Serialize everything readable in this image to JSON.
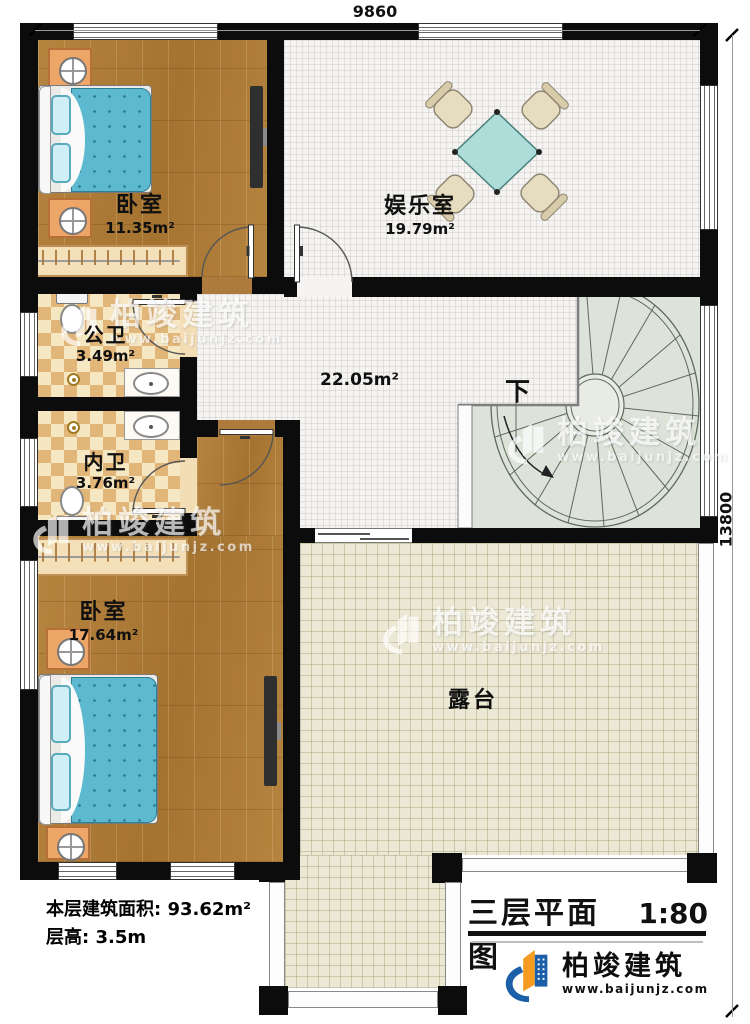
{
  "dimensions": {
    "top": "9860",
    "right": "13800"
  },
  "rooms": {
    "bedroom1": {
      "name": "卧室",
      "area": "11.35m²"
    },
    "entertainment": {
      "name": "娱乐室",
      "area": "19.79m²"
    },
    "public_bath": {
      "name": "公卫",
      "area": "3.49m²"
    },
    "private_bath": {
      "name": "内卫",
      "area": "3.76m²"
    },
    "bedroom2": {
      "name": "卧室",
      "area": "17.64m²"
    },
    "hall": {
      "area": "22.05m²"
    },
    "terrace": {
      "name": "露台"
    },
    "stairs": {
      "direction_label": "下"
    }
  },
  "info": {
    "line1_label": "本层建筑面积:",
    "line1_value": "93.62m²",
    "line2_label": "层高:",
    "line2_value": "3.5m"
  },
  "title_block": {
    "title": "三层平面图",
    "scale": "1:80"
  },
  "brand": {
    "name": "柏竣建筑",
    "url": "www.baijunjz.com"
  },
  "watermark": {
    "name": "柏竣建筑",
    "url": "www.baijunjz.com"
  },
  "colors": {
    "wall": "#0c0c0c",
    "wood_floor": "#ad7c3c",
    "terrace_floor": "#ebe8d5",
    "bath_tile": "#e2b679",
    "blanket": "#5cb9cf",
    "table": "#aedcd8",
    "brand_blue": "#1a5fa8",
    "brand_orange": "#f59b1f"
  }
}
